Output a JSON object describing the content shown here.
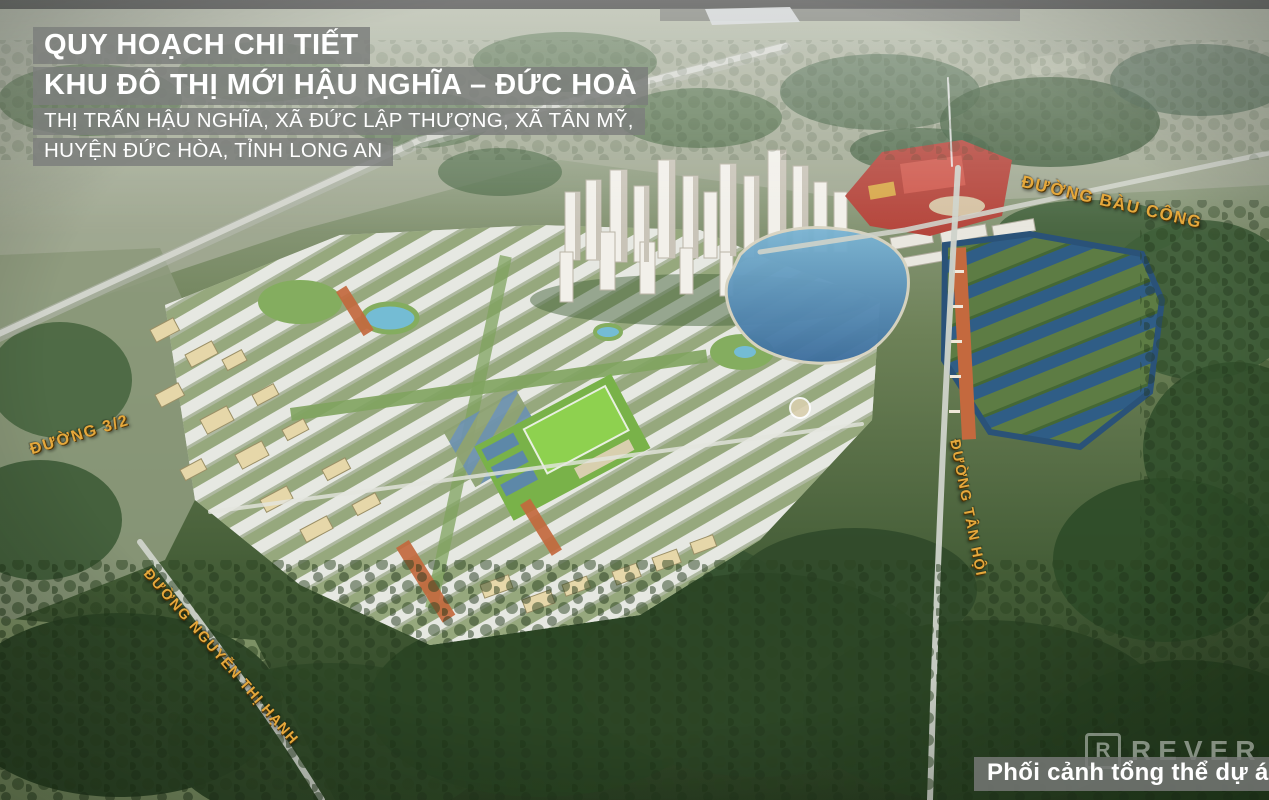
{
  "overlay": {
    "title_block": {
      "line1": "QUY HOẠCH CHI TIẾT",
      "line2": "KHU ĐÔ THỊ MỚI HẬU NGHĨA – ĐỨC HOÀ",
      "line3": "THỊ TRẤN HẬU NGHĨA, XÃ ĐỨC LẬP THƯỢNG, XÃ TÂN MỸ,",
      "line4": "HUYỆN ĐỨC HÒA, TỈNH LONG AN"
    },
    "road_labels": {
      "bau_cong": "ĐƯỜNG BÀU CÔNG",
      "duong_3_2": "ĐƯỜNG 3/2",
      "nguyen_thi_hanh": "ĐƯỜNG NGUYỄN THỊ HẠNH",
      "tan_hoi": "ĐƯỜNG TÂN HỘI"
    },
    "caption": "Phối cảnh tổng thể dự án",
    "watermark": {
      "logo_letter": "R",
      "brand": "REVER"
    }
  },
  "colors": {
    "label_gold": "#e5a83c",
    "title_bar_bg": "rgba(125,127,125,0.85)",
    "caption_bar_bg": "rgba(118,120,118,0.85)",
    "lake_blue": "#4b7fa9",
    "villa_water_blue": "#2f5d86",
    "forest_green": "#35502c",
    "townhouse_roof": "#e9ebe6",
    "orange_roof": "#c4693e",
    "red_complex": "#b5463c"
  }
}
